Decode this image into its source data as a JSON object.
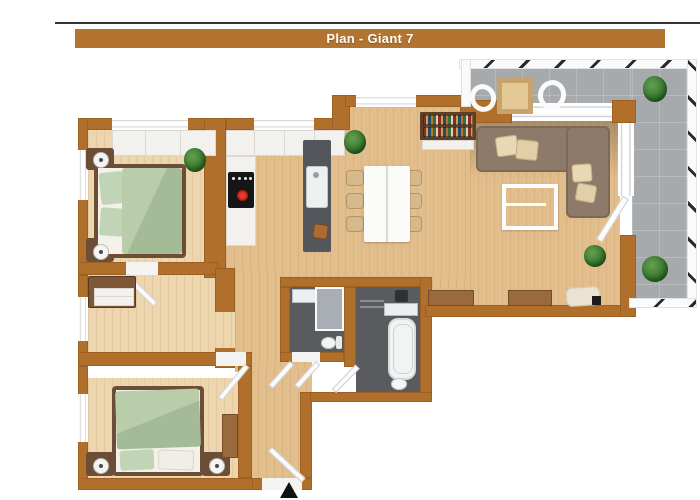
{
  "title": {
    "text": "Plan - Giant 7"
  },
  "colors": {
    "top_line": "#333333",
    "title_bar": "#b2742e",
    "title_text": "#ffffff",
    "wall": "#b06f2b",
    "wood_floor": "#e3be8d",
    "bedroom_floor": "#edd5ae",
    "bathroom_floor": "#595b5f",
    "terrace_tile": "#a6aaad",
    "bed_linen_green": "#adc3a0",
    "sofa_brown": "#8e7a68",
    "dining_chair_beige": "#d6ba8e",
    "furniture_wood": "#9a6a3c",
    "stove_knob_red": "#c9241c",
    "plant_green": "#3e7d32"
  },
  "rooms": [
    {
      "id": "bedroom-1",
      "position": "top-left",
      "furniture": [
        "wardrobe",
        "double bed with green linen",
        "2 nightstands with lamps",
        "plant"
      ]
    },
    {
      "id": "kitchen",
      "position": "top-center",
      "furniture": [
        "upper cabinets",
        "counter with stove",
        "island with sink",
        "stool",
        "bookshelf"
      ]
    },
    {
      "id": "dining-area",
      "position": "center",
      "furniture": [
        "white table",
        "6 beige chairs",
        "plant"
      ]
    },
    {
      "id": "living-room",
      "position": "right",
      "furniture": [
        "corner sofa with pillows",
        "coffee table",
        "2 sideboards",
        "plant",
        "mat with remote"
      ]
    },
    {
      "id": "terrace",
      "position": "top-right",
      "furniture": [
        "outdoor table",
        "2 chairs",
        "2 plants",
        "hatched railing"
      ]
    },
    {
      "id": "hallway",
      "position": "middle-left",
      "furniture": [
        "dresser"
      ]
    },
    {
      "id": "shower-room",
      "position": "center-left",
      "furniture": [
        "vanity",
        "glass shower",
        "toilet",
        "double door"
      ]
    },
    {
      "id": "bathroom",
      "position": "center-right",
      "furniture": [
        "washbasin counter",
        "bathtub",
        "toilet",
        "washer"
      ]
    },
    {
      "id": "bedroom-2",
      "position": "bottom-left",
      "furniture": [
        "double bed with green linen",
        "2 nightstands with lamps",
        "desk"
      ]
    },
    {
      "id": "entry-hall",
      "position": "bottom-center",
      "furniture": [
        "entrance door",
        "entrance arrow"
      ]
    }
  ]
}
